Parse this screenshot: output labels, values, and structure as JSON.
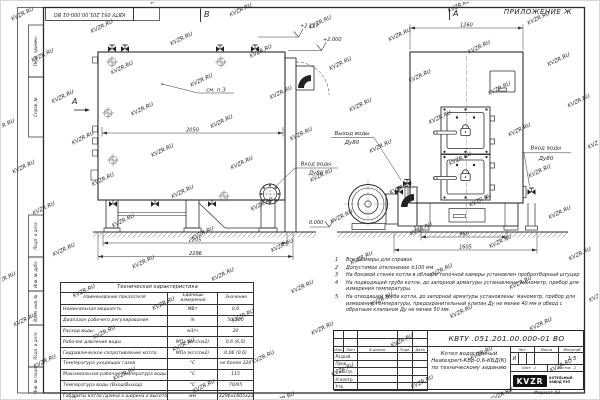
{
  "watermark": "KVZR.RU",
  "sheet": {
    "top_stamp": "КВТУ 051.201.00.000-01 ВО",
    "format_label": "Формат А3",
    "side_labels": [
      "Перв. примен.",
      "Справ. №",
      "Подп. и дата",
      "Инв. № дубл.",
      "Взам. инв. №",
      "Подп. и дата",
      "Инв. № подл."
    ]
  },
  "views": {
    "view_b": "В",
    "view_a": "А",
    "appendix": "ПРИЛОЖЕНИЕ Ж",
    "section_a": "А",
    "see_note": "см. п.3",
    "elev_top": "+2.117",
    "elev_mid": "+2.000",
    "elev_zero": "0.000",
    "outlet_label": "Выход воды",
    "outlet_dn": "Ду80",
    "inlet_label": "Вход воды",
    "inlet_dn": "Ду80",
    "inlet2_label": "Вход воды",
    "inlet2_dn": "Ду80",
    "dim_side_width": "2050",
    "dim_side_base": "2205",
    "dim_side_total": "2296",
    "dim_front_top": "1260",
    "dim_front_base": "960",
    "dim_front_total": "1605"
  },
  "tech_table": {
    "title": "Техническая характеристика",
    "headers": [
      "Наименование показателя",
      "Единицы измерения",
      "Значение"
    ],
    "rows": [
      [
        "Номинальная мощность",
        "МВт",
        "0,6"
      ],
      [
        "Диапазон рабочего регулирования",
        "%",
        "50-100"
      ],
      [
        "Расход воды",
        "м3/ч",
        "20"
      ],
      [
        "Рабочее давление воды",
        "МПа (кгс/см2)",
        "0,6 (6,0)"
      ],
      [
        "Гидравлическое сопротивление котла",
        "МПа (кгс/см2)",
        "0,06 (0,6)"
      ],
      [
        "Температура уходящих газов",
        "°С",
        "не более 220"
      ],
      [
        "Максимальная рабочая температура воды",
        "°С",
        "115"
      ],
      [
        "Температура воды (Вход/Выход)",
        "°С",
        "70/95"
      ],
      [
        "Габариты котла (длина х ширина х высота)",
        "мм",
        "2296х1605х2117"
      ]
    ]
  },
  "notes": [
    {
      "n": "1",
      "t": "Все размеры для справок"
    },
    {
      "n": "2",
      "t": "Допустимое отклонение ±100 мм."
    },
    {
      "n": "3",
      "t": "На боковой стенке котла в области топочной камеры установлен пробоотборный штуцер"
    },
    {
      "n": "4",
      "t": "На подводящей трубе котла, до запорной арматуры установлены: манометр, прибор для измерения температуры."
    },
    {
      "n": "5",
      "t": "На отводящей трубе котла, до запорной арматуры установлены: манометр, прибор для измерения температуры, предохранительный клапан Ду не менее 40 мм и обвод с обратным клапаном Ду не менее 50 мм."
    }
  ],
  "title_block": {
    "doc_number": "КВТУ .051.201.00.000-01  ВО",
    "product_line1": "Котел водогрейный",
    "product_line2": "Heatexpert-КВр-0,6-КБД(К)",
    "product_line3": "по техническому заданию",
    "col_izm": "Изм.",
    "col_list": "Лист",
    "col_doc": "N докум.",
    "col_podp": "Подп.",
    "col_data": "Дата",
    "sig_rows": [
      "Разраб.",
      "Пров.",
      "Т.контр.",
      "Н.контр.",
      "Утв."
    ],
    "lit_label": "Лит.",
    "mass_label": "Масса",
    "scale_label": "Масштаб",
    "lit_value": "И",
    "scale_value": "1:5",
    "sheet_label": "Лист",
    "sheet_value": "1",
    "sheets_label": "Листов",
    "sheets_value": "2",
    "logo": "KVZR",
    "logo_caption1": "КОТЕЛЬНЫЙ",
    "logo_caption2": "ЗАВОД РЭП"
  }
}
